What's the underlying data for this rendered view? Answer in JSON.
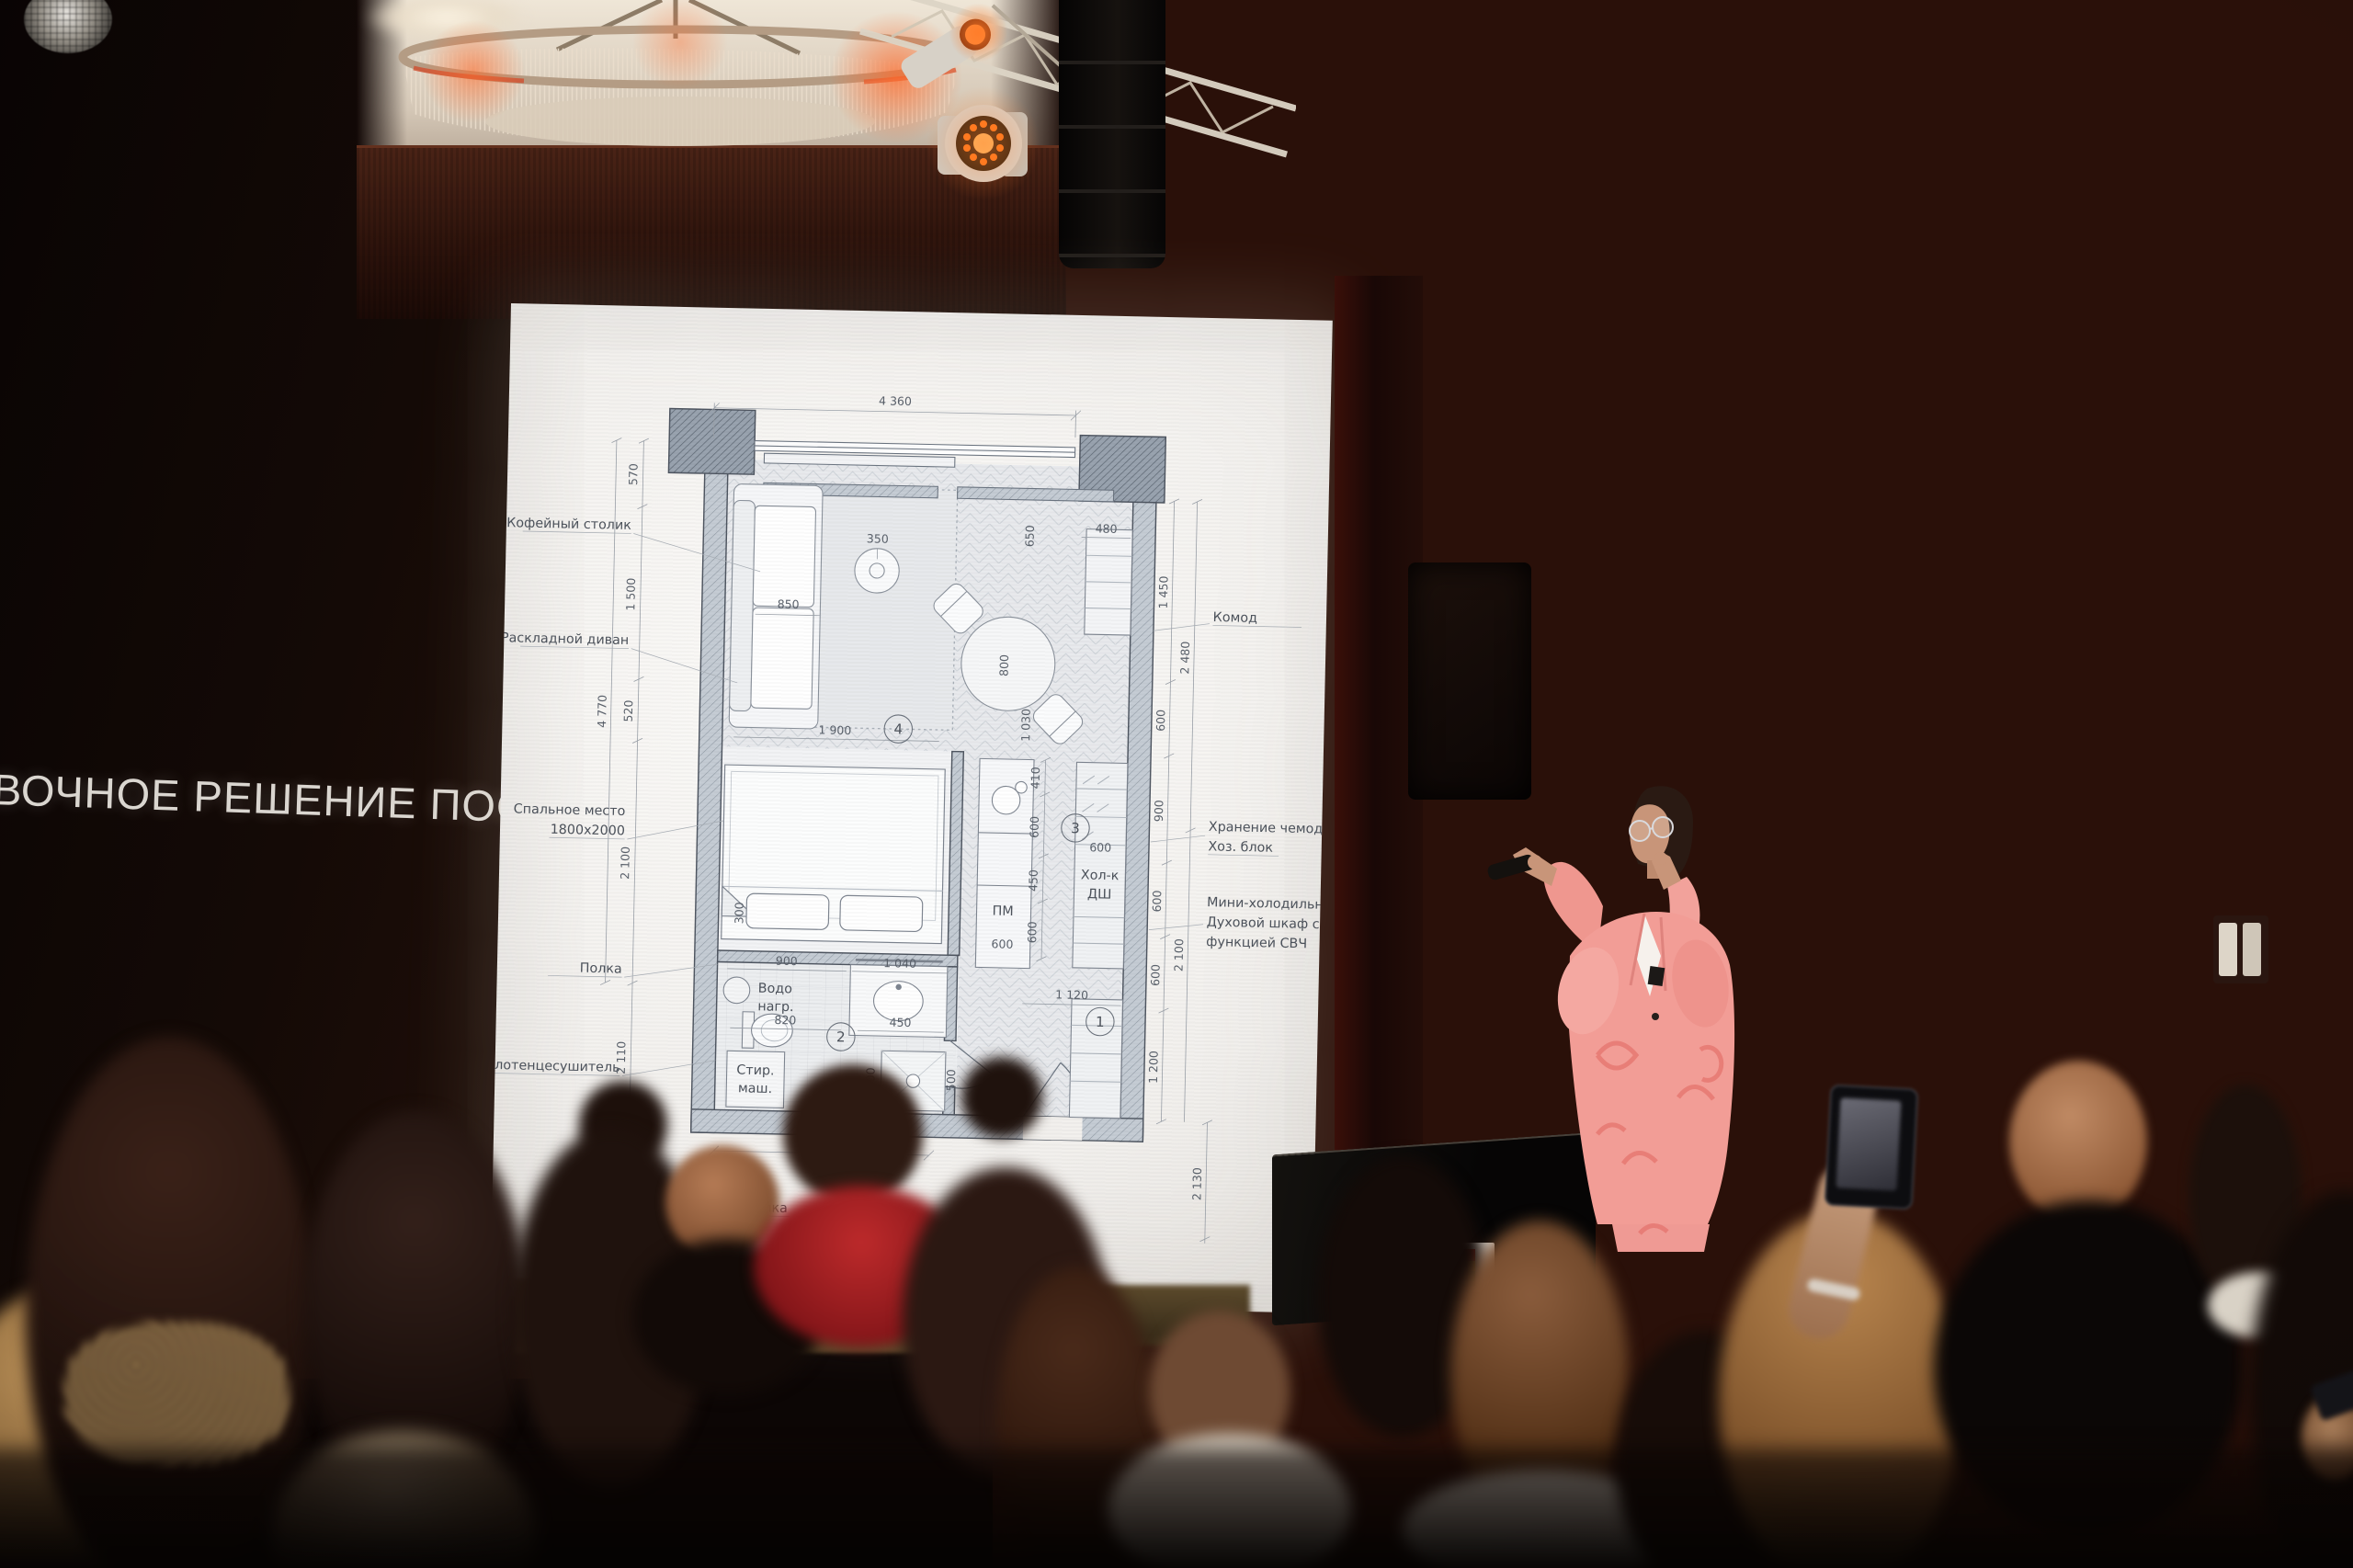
{
  "scene": {
    "slide_title": "ВОЧНОЕ РЕШЕНИЕ ПОСЛЕ"
  },
  "plan": {
    "labels_left": [
      "Кофейный столик",
      "Раскладной диван",
      "Спальное место",
      "1800х2000",
      "Полка",
      "Полотенцесушитель"
    ],
    "labels_right": [
      "Комод",
      "Хранение чемоданов",
      "Хоз. блок",
      "Мини-холодильник",
      "Духовой шкаф с",
      "функцией СВЧ"
    ],
    "label_bottom": "Полка",
    "rooms": [
      "1",
      "2",
      "3",
      "4"
    ],
    "units": {
      "water_heater_l1": "Водо",
      "water_heater_l2": "нагр.",
      "washer_l1": "Стир.",
      "washer_l2": "маш.",
      "dishwasher": "ПМ",
      "fridge": "Хол-к",
      "oven": "ДШ"
    },
    "dims": {
      "top": "4 360",
      "bottom": "1 940",
      "left": [
        "570",
        "1 500",
        "520",
        "2 100"
      ],
      "left_total": "4 770",
      "left_lower": "2 110",
      "right": [
        "1 450",
        "2 480",
        "600",
        "900",
        "600",
        "600",
        "2 100",
        "1 200",
        "2 130"
      ],
      "interior": [
        "850",
        "350",
        "800",
        "650",
        "1 030",
        "1 900",
        "410",
        "600",
        "450",
        "600",
        "600",
        "480",
        "1 120",
        "600",
        "900",
        "1 040",
        "820",
        "450",
        "300",
        "300",
        "500"
      ]
    }
  },
  "colors": {
    "suit_pink": "#f29d96",
    "wood_wall": "#3a1810",
    "screen_white": "#f4f2ef",
    "stage_glow": "#ff7a26"
  }
}
